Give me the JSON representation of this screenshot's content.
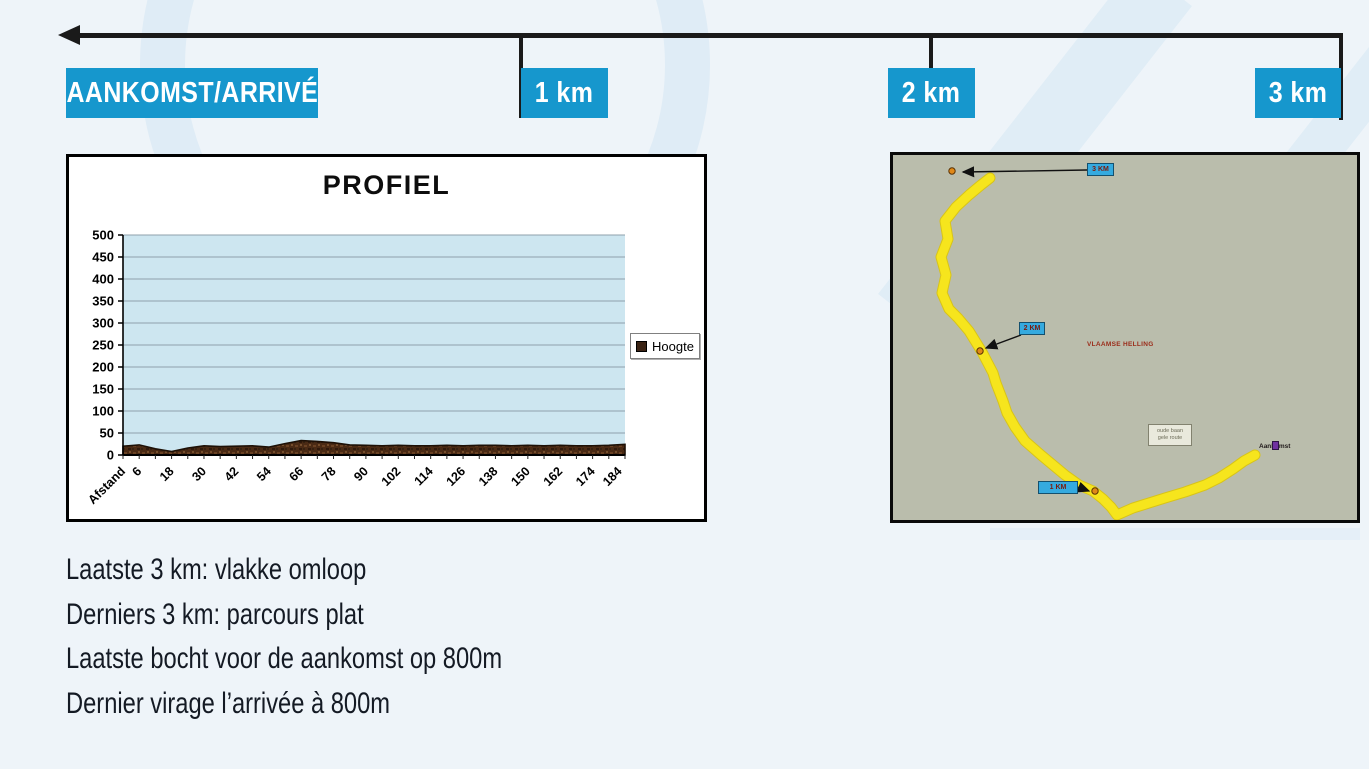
{
  "header": {
    "finish_label": "AANKOMST/ARRIVÉ",
    "km_labels": [
      "1 km",
      "2 km",
      "3 km"
    ],
    "accent_blue": "#1697cd",
    "arrow_color": "#1a1a1a"
  },
  "chart_data": {
    "type": "area",
    "title": "PROFIEL",
    "series": [
      {
        "name": "Hoogte",
        "x": [
          0,
          6,
          12,
          18,
          24,
          30,
          36,
          42,
          48,
          54,
          60,
          66,
          72,
          78,
          84,
          90,
          96,
          102,
          108,
          114,
          120,
          126,
          132,
          138,
          144,
          150,
          156,
          162,
          168,
          174,
          180,
          186
        ],
        "values": [
          20,
          23,
          14,
          8,
          16,
          21,
          19,
          20,
          21,
          18,
          26,
          33,
          31,
          28,
          23,
          22,
          21,
          22,
          21,
          21,
          22,
          21,
          22,
          22,
          21,
          22,
          21,
          22,
          21,
          21,
          22,
          24
        ]
      }
    ],
    "x_tick_labels": [
      {
        "x": 0,
        "label": "Afstand"
      },
      {
        "x": 6,
        "label": "6"
      },
      {
        "x": 18,
        "label": "18"
      },
      {
        "x": 30,
        "label": "30"
      },
      {
        "x": 42,
        "label": "42"
      },
      {
        "x": 54,
        "label": "54"
      },
      {
        "x": 66,
        "label": "66"
      },
      {
        "x": 78,
        "label": "78"
      },
      {
        "x": 90,
        "label": "90"
      },
      {
        "x": 102,
        "label": "102"
      },
      {
        "x": 114,
        "label": "114"
      },
      {
        "x": 126,
        "label": "126"
      },
      {
        "x": 138,
        "label": "138"
      },
      {
        "x": 150,
        "label": "150"
      },
      {
        "x": 162,
        "label": "162"
      },
      {
        "x": 174,
        "label": "174"
      },
      {
        "x": 184,
        "label": "184"
      }
    ],
    "y_ticks": [
      0,
      50,
      100,
      150,
      200,
      250,
      300,
      350,
      400,
      450,
      500
    ],
    "ylim": [
      0,
      500
    ],
    "xlim": [
      0,
      186
    ],
    "xlabel": "",
    "ylabel": "",
    "grid": true,
    "plot_bg": "#cde6f0",
    "grid_color": "#8fa0ab",
    "area_color": "#4a2a14",
    "area_edge_color": "#1d1006",
    "legend": {
      "label": "Hoogte",
      "position": "right"
    }
  },
  "map": {
    "bg": "#babdac",
    "route_color": "#f6e51d",
    "route_points": [
      [
        97,
        23
      ],
      [
        88,
        30
      ],
      [
        76,
        40
      ],
      [
        63,
        52
      ],
      [
        52,
        66
      ],
      [
        55,
        84
      ],
      [
        48,
        102
      ],
      [
        53,
        120
      ],
      [
        49,
        138
      ],
      [
        56,
        154
      ],
      [
        65,
        163
      ],
      [
        76,
        176
      ],
      [
        89,
        197
      ],
      [
        100,
        218
      ],
      [
        103,
        228
      ],
      [
        110,
        246
      ],
      [
        114,
        258
      ],
      [
        122,
        272
      ],
      [
        132,
        286
      ],
      [
        148,
        300
      ],
      [
        160,
        310
      ],
      [
        172,
        320
      ],
      [
        186,
        330
      ],
      [
        200,
        336
      ],
      [
        210,
        344
      ],
      [
        218,
        352
      ],
      [
        224,
        360
      ],
      [
        240,
        353
      ],
      [
        256,
        348
      ],
      [
        272,
        343
      ],
      [
        292,
        337
      ],
      [
        312,
        330
      ],
      [
        326,
        323
      ],
      [
        340,
        314
      ],
      [
        351,
        306
      ],
      [
        362,
        300
      ]
    ],
    "dots": [
      [
        59,
        16
      ],
      [
        87,
        196
      ],
      [
        202,
        336
      ]
    ],
    "dot_color": "#e08818",
    "markers": [
      {
        "label": "3 KM",
        "box": [
          194,
          8,
          27,
          13
        ],
        "arrow_from": [
          194,
          15
        ],
        "arrow_to": [
          70,
          17
        ]
      },
      {
        "label": "2 KM",
        "box": [
          126,
          167,
          26,
          13
        ],
        "arrow_from": [
          128,
          180
        ],
        "arrow_to": [
          93,
          193
        ]
      },
      {
        "label": "1 KM",
        "box": [
          145,
          326,
          40,
          13
        ],
        "arrow_from": [
          185,
          332
        ],
        "arrow_to": [
          196,
          336
        ]
      }
    ],
    "red_text": "VLAAMSE HELLING",
    "info_box_lines": [
      "oude baan",
      "gele route"
    ],
    "finish_text": "Aankomst"
  },
  "notes": {
    "lines": [
      "Laatste 3 km: vlakke omloop",
      "Derniers 3 km: parcours plat",
      "Laatste bocht voor de aankomst op 800m",
      "Dernier virage l’arrivée à 800m"
    ]
  }
}
